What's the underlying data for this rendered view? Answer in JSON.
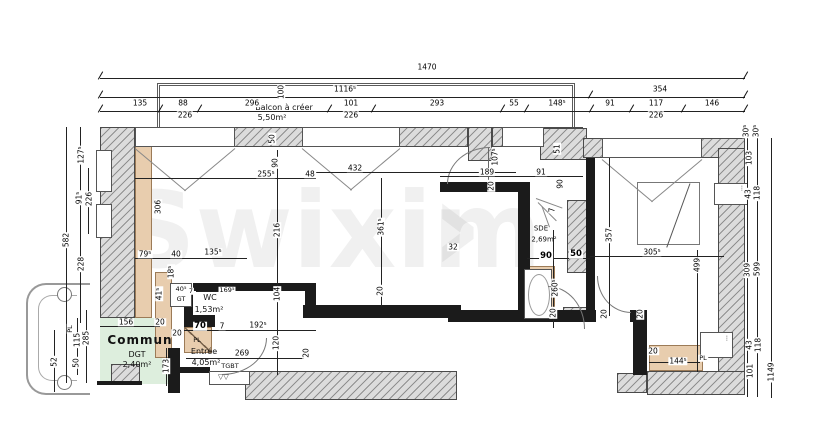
{
  "watermark": "Swixim",
  "rooms": {
    "balcon": {
      "line1": "Balcon à créer",
      "area": "5,50m²"
    },
    "commun": {
      "name": "Commun",
      "sub": "DGT",
      "area": "2,40m²"
    },
    "entree": {
      "name": "Entrée",
      "area": "4,05m²"
    },
    "wc": {
      "name": "WC",
      "area": "1,53m²"
    },
    "sde": {
      "name": "SDE",
      "area": "2,69m²"
    },
    "labels": {
      "gt": "GT",
      "tgbt": "TGBT",
      "pl1": "PL",
      "pl2": "PL"
    }
  },
  "dims": {
    "overall_width": "1470",
    "balcony_width": "1116⁵",
    "right_section": "354",
    "top_row": [
      "135",
      "88",
      "296",
      "101",
      "293",
      "55",
      "148⁵",
      "91",
      "117",
      "146"
    ],
    "window_widths": [
      "226",
      "226",
      "226"
    ],
    "top_vertical": [
      "100",
      "50",
      "90"
    ],
    "left": [
      "127⁵",
      "91⁵",
      "226",
      "582",
      "228",
      "115",
      "285",
      "50",
      "52",
      "PL"
    ],
    "right": [
      "30⁵",
      "30⁵",
      "103",
      "43",
      "118",
      "309",
      "599",
      "43",
      "118",
      "101",
      "1149"
    ],
    "room1": [
      "255⁵",
      "48",
      "306",
      "216",
      "104"
    ],
    "room2": [
      "432",
      "361⁵",
      "20",
      "32"
    ],
    "hall": [
      "189",
      "91",
      "107⁵",
      "20",
      "51",
      "90",
      "7"
    ],
    "sde": [
      "90",
      "50",
      "260⁵",
      "20",
      "20"
    ],
    "bedroom": [
      "357",
      "305⁵",
      "499",
      "20",
      "20",
      "144⁵"
    ],
    "wc_zone": [
      "79⁵",
      "40",
      "135⁵",
      "18⁵",
      "41⁵",
      "40⁵",
      "7",
      "169⁵",
      "70",
      "7",
      "192⁵",
      "20",
      "20"
    ],
    "entree_zone": [
      "156",
      "173",
      "269",
      "120",
      "20"
    ]
  }
}
